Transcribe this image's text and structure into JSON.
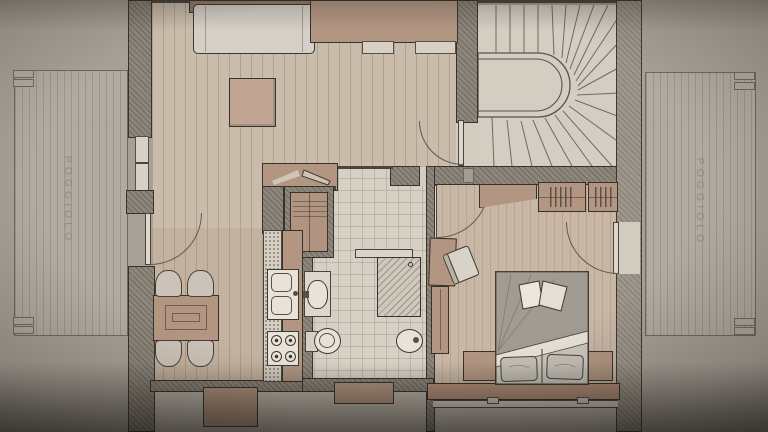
{
  "document": {
    "kind": "architectural floor plan photograph"
  },
  "labels": {
    "balcony_left": "POGGIOLO",
    "balcony_right": "POGGIOLO"
  },
  "colors": {
    "paper": "#a6a097",
    "floor_wood": "#cabcab",
    "floor_bedroom": "#c9b7a6",
    "floor_bathroom": "#d7d1c5",
    "floor_stairs": "#d3cdc2",
    "floor_balcony": "#b1aaa0",
    "wall_fill": "#8d867b",
    "wall_outline": "#37322b",
    "furniture_tan": "#b29682",
    "fixture_white": "#e8e3d8",
    "sofa_gray": "#d4d0c7",
    "duvet_gray": "#a09c93",
    "label_text": "#937f72"
  },
  "elements": {
    "rooms": [
      "living-room",
      "kitchen",
      "bathroom",
      "bedroom",
      "stairwell",
      "balcony-left",
      "balcony-right"
    ],
    "furniture": [
      "sofa",
      "sideboard",
      "coffee-table",
      "tv-console",
      "media-cabinet",
      "dining-table",
      "dining-chair",
      "kitchen-counter",
      "double-sink",
      "cooktop",
      "washbasin",
      "toilet",
      "bidet",
      "shower",
      "shelf-ledge",
      "double-bed",
      "nightstand",
      "wardrobe",
      "desk",
      "desk-chair",
      "winder-staircase",
      "window",
      "door-swing"
    ]
  }
}
